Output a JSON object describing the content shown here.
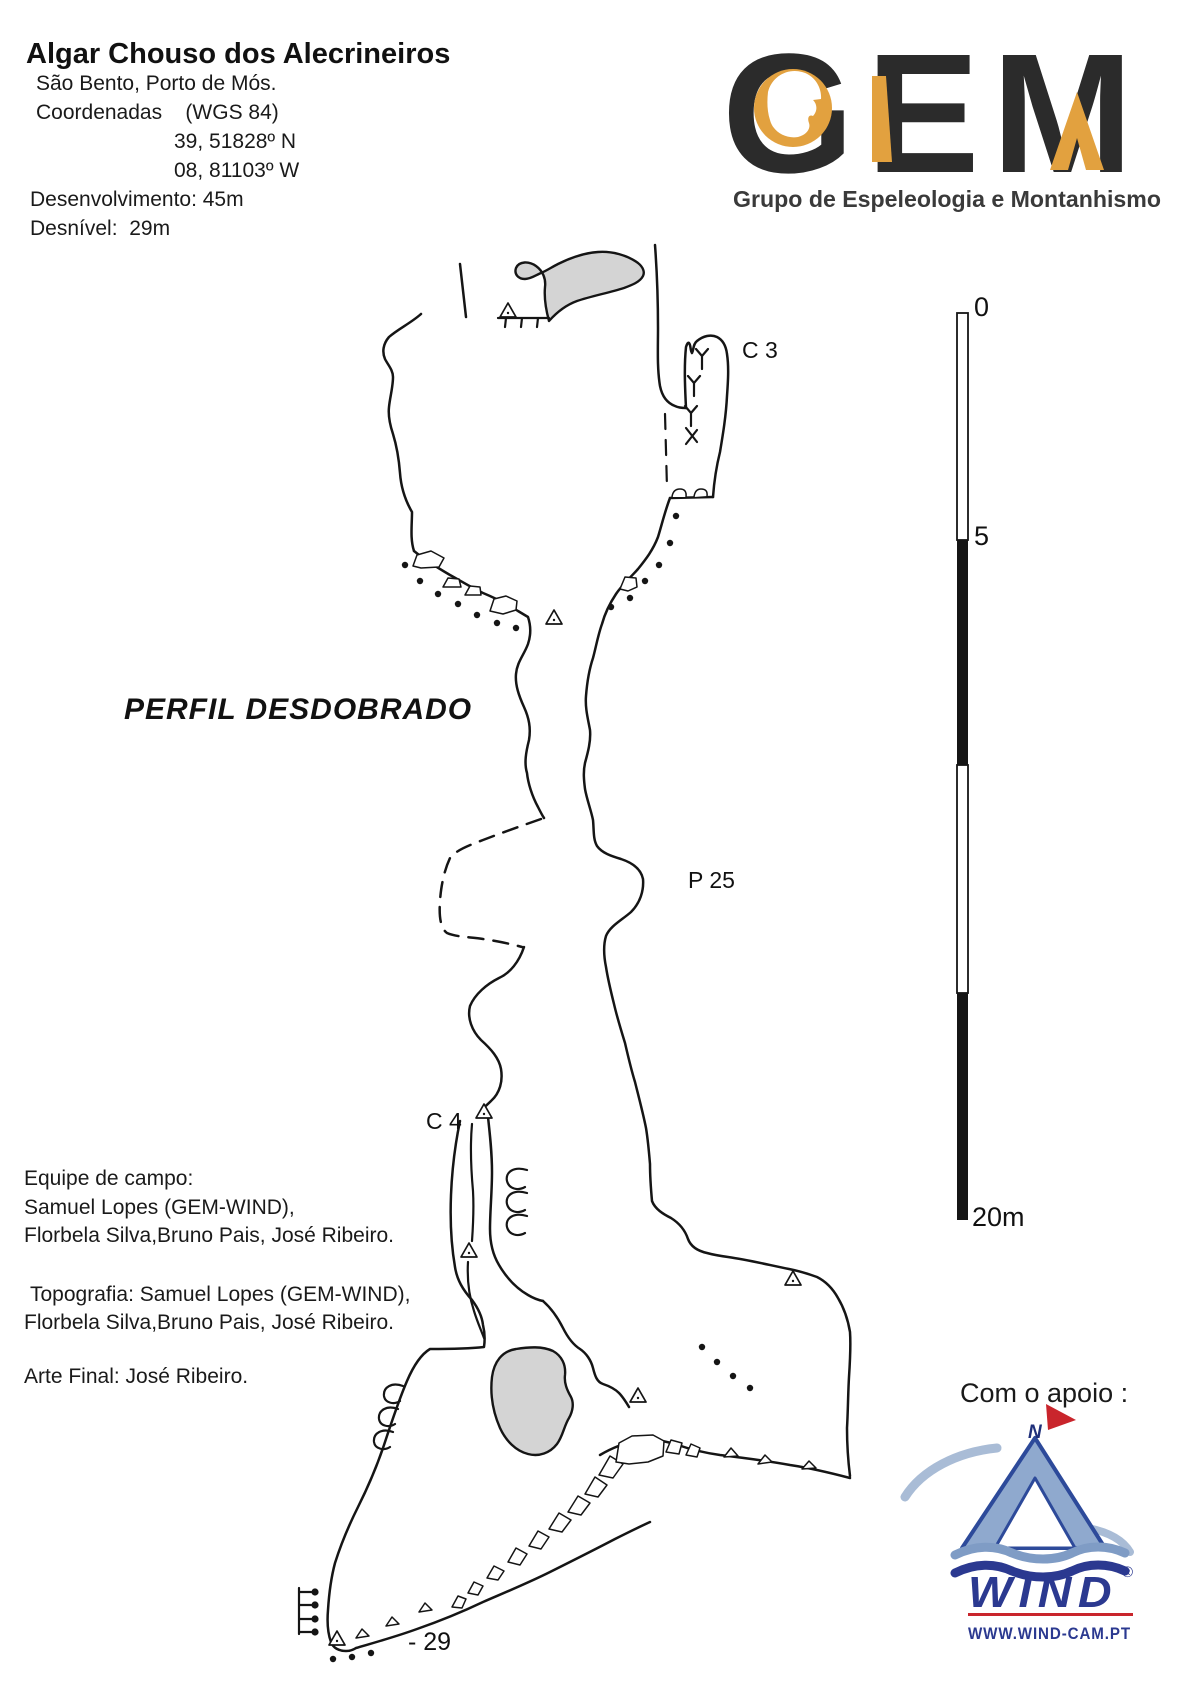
{
  "header": {
    "title": "Algar Chouso dos Alecrineiros",
    "location": "São Bento, Porto de Mós.",
    "coords_label": "Coordenadas    (WGS 84)",
    "coord_n": "39, 51828º N",
    "coord_w": "08, 81103º W",
    "development": "Desenvolvimento: 45m",
    "depth": "Desnível:  29m"
  },
  "gem_logo": {
    "acronym": "GEM",
    "subtitle": "Grupo de Espeleologia e Montanhismo",
    "dark_color": "#2b2b2b",
    "orange_color": "#e2a13f"
  },
  "map": {
    "view_label": "PERFIL DESDOBRADO",
    "label_c3": "C 3",
    "label_p25": "P 25",
    "label_c4": "C 4",
    "label_bottom_depth": "- 29"
  },
  "scale_bar": {
    "top": "0",
    "mid": "5",
    "bottom": "20m"
  },
  "credits": {
    "team_title": "Equipe de campo:",
    "team_line1": "Samuel Lopes (GEM-WIND),",
    "team_line2": "Florbela Silva,Bruno Pais, José Ribeiro.",
    "topo_line1": "Topografia: Samuel Lopes (GEM-WIND),",
    "topo_line2": "Florbela Silva,Bruno Pais, José Ribeiro.",
    "art_line": "Arte Final: José Ribeiro."
  },
  "support": {
    "label": "Com o apoio :",
    "brand": "WIND",
    "registered": "®",
    "compass_letter": "N",
    "url": "WWW.WIND-CAM.PT",
    "navy_color": "#2b3990",
    "red_color": "#c9252c",
    "lightblue_color": "#8fa9ce"
  }
}
